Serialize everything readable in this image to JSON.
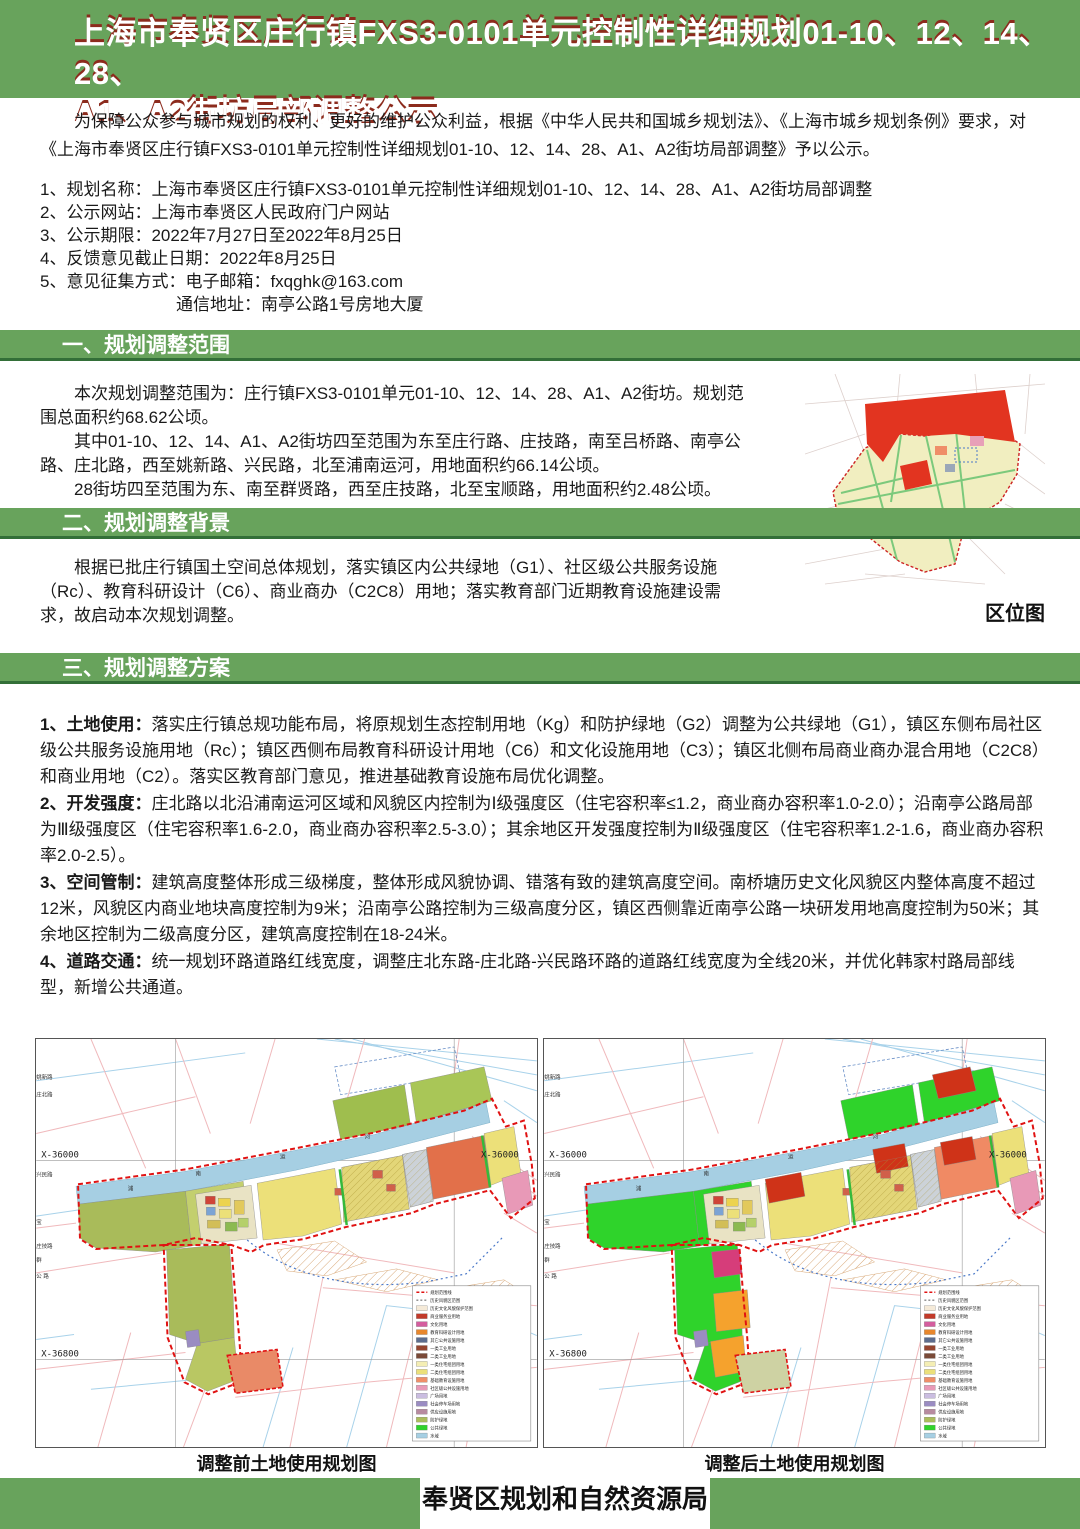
{
  "colors": {
    "accent_green": "#68a35c",
    "accent_green_dark": "#336f38",
    "title_shadow_red": "#8c2b1d",
    "boundary_red": "#e01212",
    "canal_blue": "#a6cfe3"
  },
  "banner": {
    "line1": "上海市奉贤区庄行镇FXS3-0101单元控制性详细规划01-10、12、14、28、",
    "line2": "A1、A2街坊局部调整公示"
  },
  "intro": {
    "text": "为保障公众参与城市规划的权利、更好的维护公众利益，根据《中华人民共和国城乡规划法》、《上海市城乡规划条例》要求，对《上海市奉贤区庄行镇FXS3-0101单元控制性详细规划01-10、12、14、28、A1、A2街坊局部调整》予以公示。"
  },
  "info_list": [
    "1、规划名称：上海市奉贤区庄行镇FXS3-0101单元控制性详细规划01-10、12、14、28、A1、A2街坊局部调整",
    "2、公示网站：上海市奉贤区人民政府门户网站",
    "3、公示期限：2022年7月27日至2022年8月25日",
    "4、反馈意见截止日期：2022年8月25日",
    "5、意见征集方式：电子邮箱：fxqghk@163.com",
    "通信地址：南亭公路1号房地大厦"
  ],
  "sections": {
    "s1": {
      "heading": "一、规划调整范围",
      "paras": [
        "本次规划调整范围为：庄行镇FXS3-0101单元01-10、12、14、28、A1、A2街坊。规划范围总面积约68.62公顷。",
        "其中01-10、12、14、A1、A2街坊四至范围为东至庄行路、庄技路，南至吕桥路、南亭公路、庄北路，西至姚新路、兴民路，北至浦南运河，用地面积约66.14公顷。",
        "28街坊四至范围为东、南至群贤路，西至庄技路，北至宝顺路，用地面积约2.48公顷。"
      ]
    },
    "s2": {
      "heading": "二、规划调整背景",
      "paras": [
        "根据已批庄行镇国土空间总体规划，落实镇区内公共绿地（G1）、社区级公共服务设施（Rc）、教育科研设计（C6）、商业商办（C2C8）用地；落实教育部门近期教育设施建设需求，故启动本次规划调整。"
      ]
    },
    "s3": {
      "heading": "三、规划调整方案",
      "items": [
        {
          "label": "1、土地使用：",
          "text": "落实庄行镇总规功能布局，将原规划生态控制用地（Kg）和防护绿地（G2）调整为公共绿地（G1），镇区东侧布局社区级公共服务设施用地（Rc）；镇区西侧布局教育科研设计用地（C6）和文化设施用地（C3）；镇区北侧布局商业商办混合用地（C2C8）和商业用地（C2）。落实区教育部门意见，推进基础教育设施布局优化调整。"
        },
        {
          "label": "2、开发强度：",
          "text": "庄北路以北沿浦南运河区域和风貌区内控制为Ⅰ级强度区（住宅容积率≤1.2，商业商办容积率1.0-2.0）；沿南亭公路局部为Ⅲ级强度区（住宅容积率1.6-2.0，商业商办容积率2.5-3.0）；其余地区开发强度控制为Ⅱ级强度区（住宅容积率1.2-1.6，商业商办容积率2.0-2.5）。"
        },
        {
          "label": "3、空间管制：",
          "text": "建筑高度整体形成三级梯度，整体形成风貌协调、错落有致的建筑高度空间。南桥塘历史文化风貌区内整体高度不超过12米，风貌区内商业地块高度控制为9米；沿南亭公路控制为三级高度分区，镇区西侧靠近南亭公路一块研发用地高度控制为50米；其余地区控制为二级高度分区，建筑高度控制在18-24米。"
        },
        {
          "label": "4、道路交通：",
          "text": "统一规划环路道路红线宽度，调整庄北东路-庄北路-兴民路环路的道路红线宽度为全线20米，并优化韩家村路局部线型，新增公共通道。"
        }
      ]
    }
  },
  "location_map": {
    "caption": "区位图"
  },
  "maps": {
    "coord_top": "X-36000",
    "coord_bottom": "X-36800",
    "canal_chars": [
      "浦",
      "南",
      "运",
      "河"
    ],
    "road_labels": {
      "zhuangbei": "庄北路",
      "yaoxin": "姚新路",
      "xingmin": "兴民路",
      "zhuangji": "庄技路",
      "nanting": "公 路",
      "qunxian": "群",
      "baoshun": "宝",
      "zhuanghang": "庄行路"
    },
    "before": {
      "caption": "调整前土地使用规划图",
      "palette": {
        "nr1": "#9fbe4e",
        "nr2": "#a9c657",
        "band_left": "#a9bb5a",
        "band_left2": "#c3cf6e",
        "cluster_base": "#e9e3c4",
        "yellow": "#ece079",
        "hatch_yellow": "#e3d678",
        "gray": "#ccd2d8",
        "big_right": "#e2704a",
        "right_yellow": "#ece079",
        "pink": "#e899b7",
        "red": "transparent",
        "lobe": "#a9bb5a",
        "lobe2": "#b9c763",
        "magenta": "transparent",
        "orange": "transparent",
        "purple": "#9a8cc2",
        "isolated": "#e98a67"
      }
    },
    "after": {
      "caption": "调整后土地使用规划图",
      "palette": {
        "nr1": "#2fd32b",
        "nr2": "#2fd32b",
        "band_left": "#2fd32b",
        "band_left2": "#2fd32b",
        "cluster_base": "#e9e3c4",
        "yellow": "#ece079",
        "hatch_yellow": "#e3d678",
        "gray": "#ccd2d8",
        "big_right": "#f08a64",
        "right_yellow": "#ece079",
        "pink": "#e899b7",
        "red": "#cf3318",
        "lobe": "#2fd32b",
        "lobe2": "#2fd32b",
        "magenta": "#d63d7a",
        "orange": "#f5a22d",
        "purple": "#9a8cc2",
        "isolated": "#ced2a3"
      }
    },
    "legend": [
      {
        "c": "dash-red",
        "t": "规划范围线"
      },
      {
        "c": "dash-gray",
        "t": "历史风貌区范围"
      },
      {
        "c": "#f5ead8",
        "t": "历史文化风貌保护范围"
      },
      {
        "c": "#c23a2a",
        "t": "商业服务业用地"
      },
      {
        "c": "#d45d9e",
        "t": "文化用地"
      },
      {
        "c": "#e8872c",
        "t": "教育科研设计用地"
      },
      {
        "c": "#5d6d8e",
        "t": "其它公共设施用地"
      },
      {
        "c": "#96452f",
        "t": "一类工业用地"
      },
      {
        "c": "#7a4a38",
        "t": "二类工业用地"
      },
      {
        "c": "#f4eeb4",
        "t": "一类住宅组团用地"
      },
      {
        "c": "#ebe07a",
        "t": "二类住宅组团用地"
      },
      {
        "c": "#ef8e68",
        "t": "基础教育设施用地"
      },
      {
        "c": "#e899b7",
        "t": "社区级公共设施用地"
      },
      {
        "c": "#cabde0",
        "t": "广场用地"
      },
      {
        "c": "#9a8cc2",
        "t": "社会停车场用地"
      },
      {
        "c": "#b78ba0",
        "t": "供应设施用地"
      },
      {
        "c": "#abbd5b",
        "t": "防护绿地"
      },
      {
        "c": "#2fd32b",
        "t": "公共绿地"
      },
      {
        "c": "#a6cfe3",
        "t": "水域"
      }
    ]
  },
  "footer": {
    "label": "奉贤区规划和自然资源局"
  }
}
